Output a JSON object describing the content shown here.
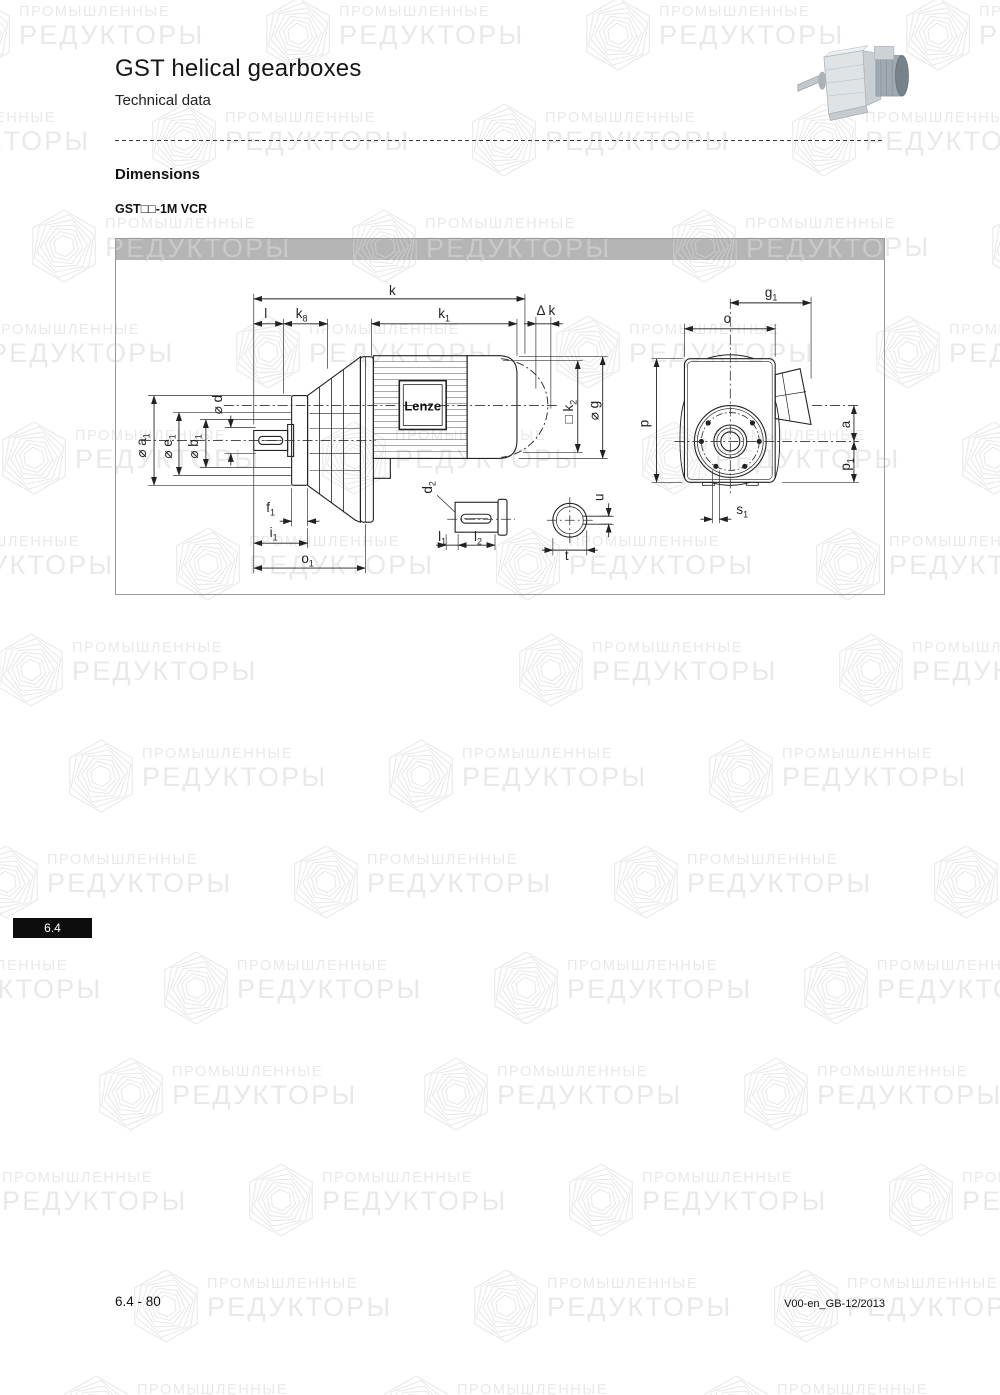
{
  "page": {
    "title": "GST helical gearboxes",
    "subtitle": "Technical data",
    "section_heading": "Dimensions",
    "model_label": "GST□□-1M VCR",
    "side_tab": "6.4",
    "footer_left": "6.4 - 80",
    "footer_right": "V00-en_GB-12/2013"
  },
  "colors": {
    "gray_bar": "#b5b5b5",
    "watermark": "#e9e9e9",
    "bar_watermark": "#c9c9c9",
    "tab_bg": "#0d0d0d",
    "line": "#222222"
  },
  "watermark": {
    "line1": "ПРОМЫШЛЕННЫЕ",
    "line2": "РЕДУКТОРЫ",
    "tiles": [
      {
        "x": -58,
        "y": -8
      },
      {
        "x": 262,
        "y": -8
      },
      {
        "x": 582,
        "y": -8
      },
      {
        "x": 902,
        "y": -8
      },
      {
        "x": -172,
        "y": 98
      },
      {
        "x": 148,
        "y": 98
      },
      {
        "x": 468,
        "y": 98
      },
      {
        "x": 788,
        "y": 98
      },
      {
        "x": 28,
        "y": 204
      },
      {
        "x": 348,
        "y": 204
      },
      {
        "x": 668,
        "y": 204
      },
      {
        "x": 988,
        "y": 204
      },
      {
        "x": -88,
        "y": 310
      },
      {
        "x": 232,
        "y": 310
      },
      {
        "x": 552,
        "y": 310
      },
      {
        "x": 872,
        "y": 310
      },
      {
        "x": -2,
        "y": 416
      },
      {
        "x": 318,
        "y": 416
      },
      {
        "x": 638,
        "y": 416
      },
      {
        "x": 958,
        "y": 416
      },
      {
        "x": -148,
        "y": 522
      },
      {
        "x": 172,
        "y": 522
      },
      {
        "x": 492,
        "y": 522
      },
      {
        "x": 812,
        "y": 522
      },
      {
        "x": -5,
        "y": 628
      },
      {
        "x": 515,
        "y": 628
      },
      {
        "x": 835,
        "y": 628
      },
      {
        "x": 65,
        "y": 734
      },
      {
        "x": 385,
        "y": 734
      },
      {
        "x": 705,
        "y": 734
      },
      {
        "x": -30,
        "y": 840
      },
      {
        "x": 290,
        "y": 840
      },
      {
        "x": 610,
        "y": 840
      },
      {
        "x": 930,
        "y": 840
      },
      {
        "x": -160,
        "y": 946
      },
      {
        "x": 160,
        "y": 946
      },
      {
        "x": 490,
        "y": 946
      },
      {
        "x": 800,
        "y": 946
      },
      {
        "x": 95,
        "y": 1052
      },
      {
        "x": 420,
        "y": 1052
      },
      {
        "x": 740,
        "y": 1052
      },
      {
        "x": -75,
        "y": 1158
      },
      {
        "x": 245,
        "y": 1158
      },
      {
        "x": 565,
        "y": 1158
      },
      {
        "x": 885,
        "y": 1158
      },
      {
        "x": 130,
        "y": 1264
      },
      {
        "x": 470,
        "y": 1264
      },
      {
        "x": 770,
        "y": 1264
      },
      {
        "x": 60,
        "y": 1370
      },
      {
        "x": 380,
        "y": 1370
      },
      {
        "x": 700,
        "y": 1370
      }
    ],
    "bar_tiles": [
      {
        "x": -87
      },
      {
        "x": 233
      },
      {
        "x": 553
      }
    ]
  },
  "drawing": {
    "brand_label": "Lenze",
    "dim_labels": [
      {
        "id": "dim-k",
        "t": "k",
        "s": "",
        "x": 277,
        "y": 56,
        "r": 0
      },
      {
        "id": "dim-l",
        "t": "l",
        "s": "",
        "x": 150,
        "y": 79,
        "r": 0
      },
      {
        "id": "dim-k8",
        "t": "k",
        "s": "8",
        "x": 186,
        "y": 79,
        "r": 0
      },
      {
        "id": "dim-k1",
        "t": "k",
        "s": "1",
        "x": 329,
        "y": 79,
        "r": 0
      },
      {
        "id": "dim-delta-k",
        "t": "Δ k",
        "s": "",
        "x": 431,
        "y": 76,
        "r": 0
      },
      {
        "id": "dim-g1",
        "t": "g",
        "s": "1",
        "x": 657,
        "y": 58,
        "r": 0
      },
      {
        "id": "dim-o",
        "t": "o",
        "s": "",
        "x": 613,
        "y": 84,
        "r": 0
      },
      {
        "id": "dim-d",
        "t": "⌀ d",
        "s": "",
        "x": 106,
        "y": 166,
        "r": -90
      },
      {
        "id": "dim-a1",
        "t": "⌀ a",
        "s": "1",
        "x": 30,
        "y": 207,
        "r": -90
      },
      {
        "id": "dim-e1",
        "t": "⌀ e",
        "s": "1",
        "x": 56,
        "y": 208,
        "r": -90
      },
      {
        "id": "dim-b1",
        "t": "⌀ b",
        "s": "1",
        "x": 82,
        "y": 208,
        "r": -90
      },
      {
        "id": "dim-k2",
        "t": "□ k",
        "s": "2",
        "x": 458,
        "y": 173,
        "r": -90
      },
      {
        "id": "dim-g",
        "t": "⌀ g",
        "s": "",
        "x": 484,
        "y": 172,
        "r": -90
      },
      {
        "id": "dim-p",
        "t": "p",
        "s": "",
        "x": 534,
        "y": 185,
        "r": -90
      },
      {
        "id": "dim-a",
        "t": "a",
        "s": "",
        "x": 736,
        "y": 186,
        "r": -90
      },
      {
        "id": "dim-p1",
        "t": "p",
        "s": "1",
        "x": 736,
        "y": 226,
        "r": -90
      },
      {
        "id": "dim-s1",
        "t": "s",
        "s": "1",
        "x": 628,
        "y": 276,
        "r": 0
      },
      {
        "id": "dim-f1",
        "t": "f",
        "s": "1",
        "x": 155,
        "y": 274,
        "r": 0
      },
      {
        "id": "dim-i1",
        "t": "i",
        "s": "1",
        "x": 158,
        "y": 299,
        "r": 0
      },
      {
        "id": "dim-o1",
        "t": "o",
        "s": "1",
        "x": 192,
        "y": 325,
        "r": 0
      },
      {
        "id": "dim-d2",
        "t": "d",
        "s": "2",
        "x": 317,
        "y": 249,
        "r": -90
      },
      {
        "id": "dim-l1",
        "t": "l",
        "s": "1",
        "x": 327,
        "y": 303,
        "r": 0
      },
      {
        "id": "dim-l2",
        "t": "l",
        "s": "2",
        "x": 363,
        "y": 303,
        "r": 0
      },
      {
        "id": "dim-u",
        "t": "u",
        "s": "",
        "x": 489,
        "y": 259,
        "r": -90
      },
      {
        "id": "dim-t",
        "t": "t",
        "s": "",
        "x": 452,
        "y": 322,
        "r": 0
      }
    ]
  }
}
